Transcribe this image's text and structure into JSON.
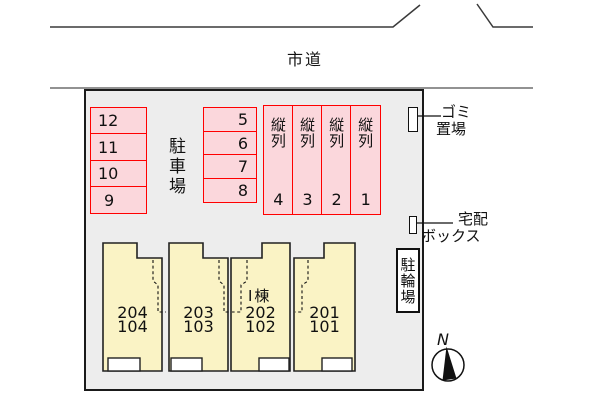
{
  "road": {
    "label": "市道"
  },
  "site": {
    "fill": "#EDEDED",
    "border_color": "#1A1A1A"
  },
  "parking": {
    "area_label": "駐車場",
    "stall_fill": "#FBD7DC",
    "stall_border": "#FF0000",
    "left_column": [
      "12",
      "11",
      "10",
      "9"
    ],
    "middle_column": [
      "5",
      "6",
      "7",
      "8"
    ],
    "tandem_label": "縦列",
    "tandem_numbers": [
      "4",
      "3",
      "2",
      "1"
    ]
  },
  "building": {
    "name": "Ⅰ棟",
    "fill": "#FAF3C5",
    "units": [
      {
        "upper": "204",
        "lower": "104"
      },
      {
        "upper": "203",
        "lower": "103"
      },
      {
        "upper": "202",
        "lower": "102"
      },
      {
        "upper": "201",
        "lower": "101"
      }
    ]
  },
  "facilities": {
    "garbage_line1": "ゴミ",
    "garbage_line2": "置場",
    "delivery_line1": "宅配",
    "delivery_line2": "ボックス",
    "bicycle": "駐輪場"
  },
  "compass": {
    "north": "N"
  }
}
